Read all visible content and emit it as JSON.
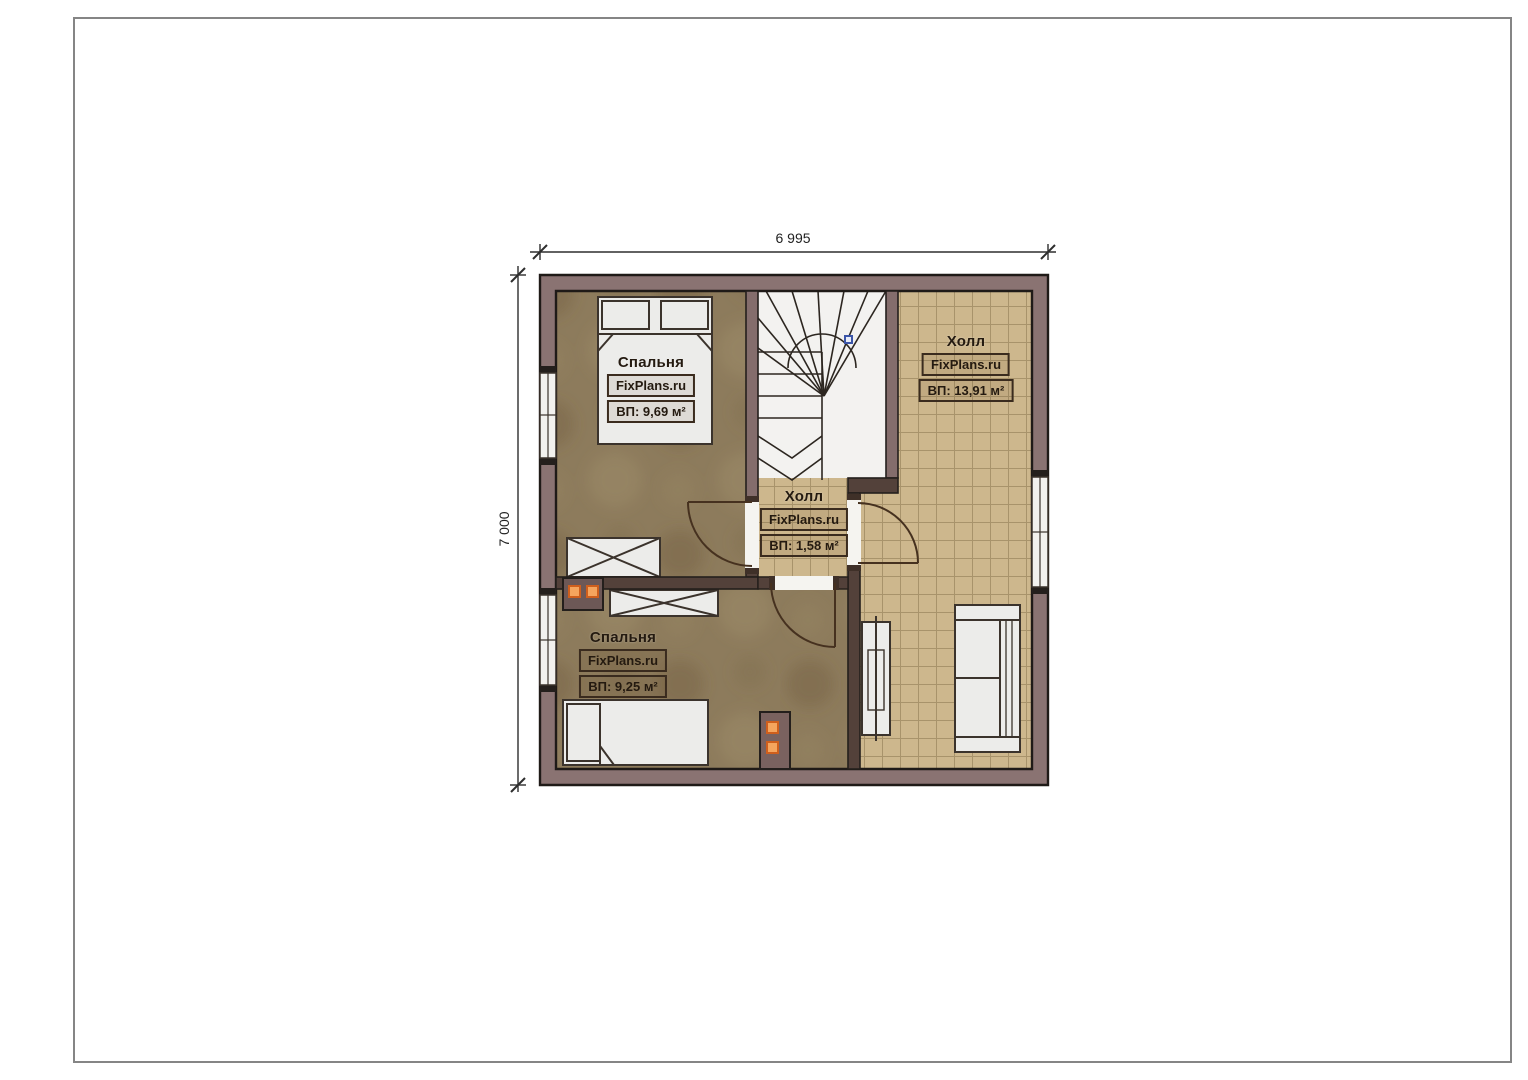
{
  "page": {
    "frame_color": "#858585",
    "background": "#ffffff"
  },
  "plan": {
    "dimensions": {
      "width_label": "6 995",
      "height_label": "7 000"
    },
    "watermark": "FixPlans.ru",
    "rooms": [
      {
        "name": "Спальня",
        "watermark": "FixPlans.ru",
        "area": "ВП: 9,69 м²"
      },
      {
        "name": "Холл",
        "watermark": "FixPlans.ru",
        "area": "ВП: 13,91 м²"
      },
      {
        "name": "Холл",
        "watermark": "FixPlans.ru",
        "area": "ВП: 1,58 м²"
      },
      {
        "name": "Спальня",
        "watermark": "FixPlans.ru",
        "area": "ВП: 9,25 м²"
      }
    ],
    "colors": {
      "outer_wall": "#8a7372",
      "partition_wall": "#53413a",
      "bedroom_floor": "#8d7b5c",
      "tile_floor": "#cdb78d",
      "stairwell_floor": "#f3f2f0",
      "furniture_fill": "#ececea",
      "chimney_orange": "#f5a55e",
      "stair_marker_blue": "#3b55a8",
      "label_text": "#241a10",
      "dimension_line": "#2e2e2e"
    }
  }
}
